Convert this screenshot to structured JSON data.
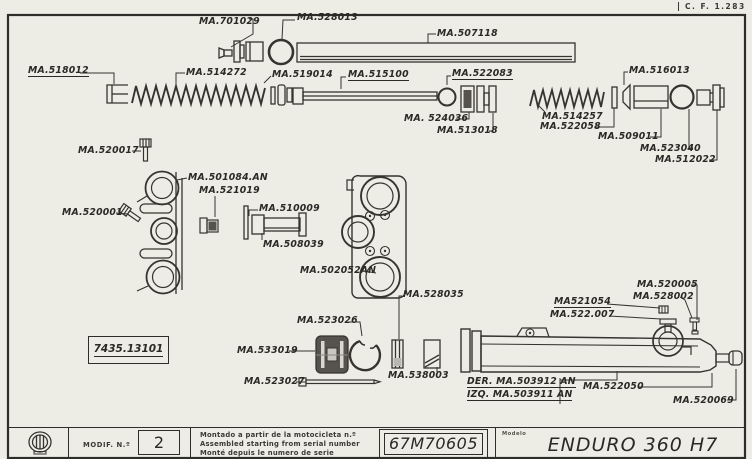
{
  "page": {
    "doc_ref": "C. F. 1.283"
  },
  "colors": {
    "ink": "#35342f",
    "paper": "#edece5",
    "dark_fill": "#55534c"
  },
  "stamp": {
    "ref": "7435.13101"
  },
  "parts": {
    "p701029": "MA.701029",
    "p528013": "MA.528013",
    "p507118": "MA.507118",
    "p518012": "MA.518012",
    "p514272": "MA.514272",
    "p519014": "MA.519014",
    "p515100": "MA.515100",
    "p522083": "MA.522083",
    "p524036": "MA. 524036",
    "p513018": "MA.513018",
    "p516013": "MA.516013",
    "p514257": "MA.514257",
    "p522058": "MA.522058",
    "p509011": "MA.509011",
    "p523040": "MA.523040",
    "p512022": "MA.512022",
    "p520017": "MA.520017",
    "p501084": "MA.501084.AN",
    "p521019": "MA.521019",
    "p520001": "MA.520001",
    "p510009": "MA.510009",
    "p508039": "MA.508039",
    "p502052": "MA.502052AN",
    "p528035": "MA.528035",
    "p523026": "MA.523026",
    "p533019": "MA.533019",
    "p523027": "MA.523027",
    "p538003": "MA.538003",
    "p520005": "MA.520005",
    "p528002": "MA.528002",
    "p521054": "MA521054",
    "p522007": "MA.522.007",
    "p503912": "DER. MA.503912 AN",
    "p503911": "IZQ. MA.503911 AN",
    "p522050": "MA.522050",
    "p520069": "MA.520069"
  },
  "footer": {
    "modif_label": "MODIF. N.º",
    "modif_value": "2",
    "serial_note_es": "Montado a partir de la motocicleta n.º",
    "serial_note_en": "Assembled starting from serial number",
    "serial_note_fr": "Monté depuis le numero de serie",
    "serial_number": "67M70605",
    "model_label": "Modelo",
    "model_value": "ENDURO 360 H7"
  }
}
